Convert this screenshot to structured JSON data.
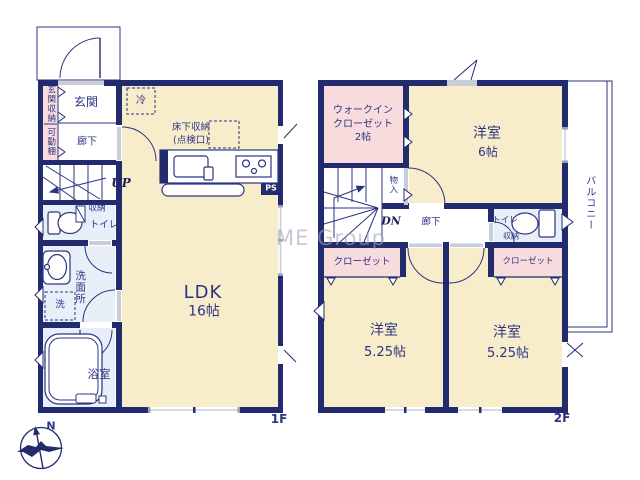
{
  "watermark": "ME Group",
  "compass": {
    "north": "N"
  },
  "colors": {
    "wall_navy": "#232b6f",
    "room_cream": "#f8edca",
    "room_pink": "#f8dcdd",
    "room_blue": "#e8eff8",
    "window_gray": "#c9cdda",
    "text_navy": "#2c3484"
  },
  "f1": {
    "floor_label": "1F",
    "entrance_storage": "玄関収納",
    "movable_shelf": "可動棚",
    "entrance": "玄関",
    "hallway": "廊下",
    "fridge": "冷",
    "underfloor_storage": "床下収納\n(点検口)",
    "up": "UP",
    "ps": "PS",
    "storage": "収納",
    "toilet": "トイレ",
    "washroom": "洗面所",
    "washer": "洗",
    "bathroom": "浴室",
    "ldk": "LDK",
    "ldk_size": "16帖"
  },
  "f2": {
    "floor_label": "2F",
    "wic": "ウォークイン\nクローゼット\n2帖",
    "bedroom_n": "洋室",
    "bedroom_n_size": "6帖",
    "storage_small": "物入",
    "dn": "DN",
    "hallway": "廊下",
    "toilet": "トイレ",
    "toilet_storage": "収納",
    "closet_w": "クローゼット",
    "closet_e": "クローゼット",
    "bedroom_sw": "洋室",
    "bedroom_sw_size": "5.25帖",
    "bedroom_se": "洋室",
    "bedroom_se_size": "5.25帖",
    "balcony": "バルコニー"
  }
}
